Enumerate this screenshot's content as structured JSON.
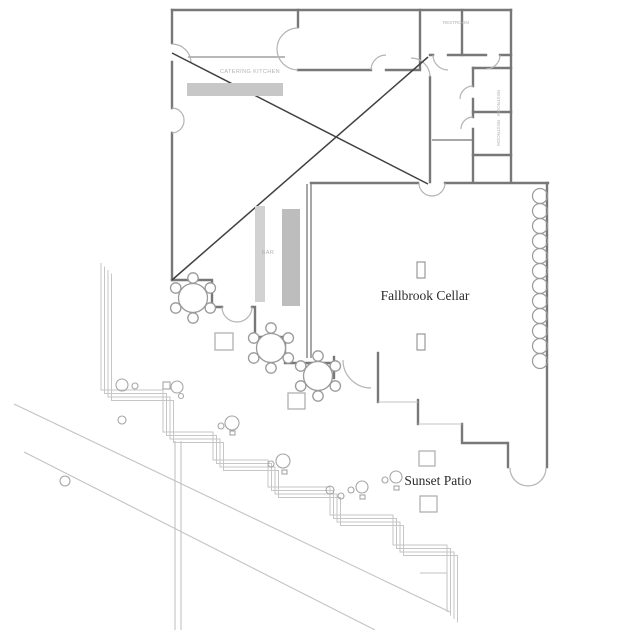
{
  "plan": {
    "title": "Fallbrook Cellar floor plan",
    "labels": {
      "main_room": "Fallbrook Cellar",
      "patio": "Sunset Patio",
      "kitchen": "CATERING KITCHEN",
      "bar": "BAR",
      "restroom_top": "RESTROOM",
      "restroom_1": "RESTROOM",
      "restroom_2": "RESTROOM"
    },
    "colors": {
      "wall": "#787878",
      "light_line": "#c3c3c3",
      "counter_fill": "#c7c7c7",
      "bar_fill": "#bdbdbd",
      "cross_line": "#404040",
      "room_label_text": "#2b2b2b",
      "tiny_label_text": "#b2b2b2",
      "background": "#ffffff"
    }
  }
}
